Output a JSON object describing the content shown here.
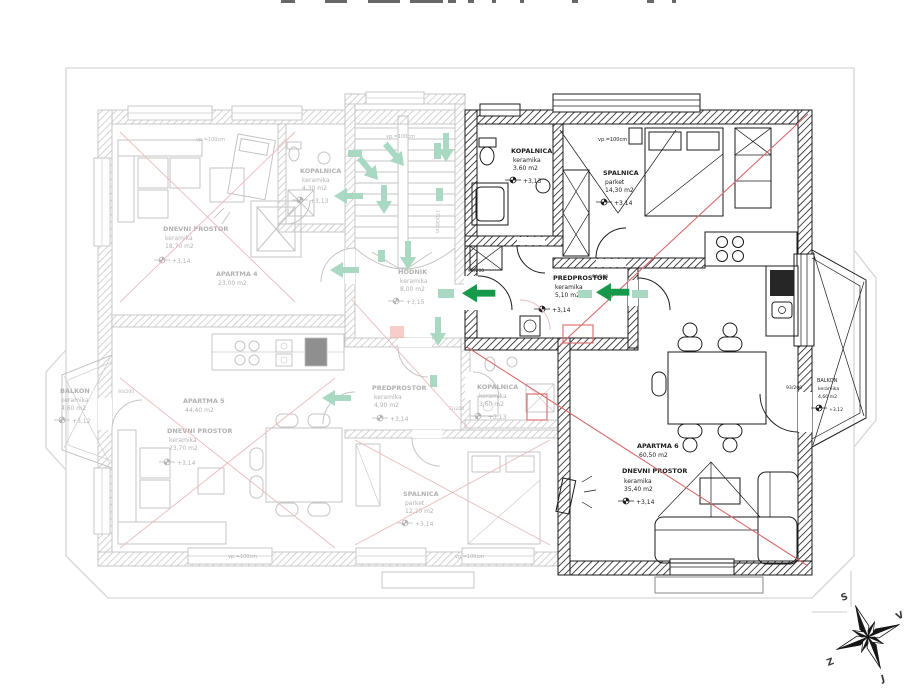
{
  "apartments": [
    {
      "label": "APARTMA 4",
      "area": "23,00 m2",
      "rooms": [
        {
          "name": "DNEVNI PROSTOR",
          "material": "keramika",
          "area": "18,70 m2",
          "level": "+3,14"
        },
        {
          "name": "KOPALNICA",
          "material": "keramika",
          "area": "4,30 m2",
          "level": "+3,13"
        }
      ]
    },
    {
      "label": "APARTMA 5",
      "area": "44,40 m2",
      "rooms": [
        {
          "name": "DNEVNI PROSTOR",
          "material": "keramika",
          "area": "23,70 m2",
          "level": "+3,14"
        },
        {
          "name": "PREDPROSTOR",
          "material": "keramika",
          "area": "4,90 m2",
          "level": "+3,14"
        },
        {
          "name": "KOPALNICA",
          "material": "keramika",
          "area": "3,60 m2",
          "level": "+3,13"
        },
        {
          "name": "SPALNICA",
          "material": "parket",
          "area": "12,20 m2",
          "level": "+3,14"
        },
        {
          "name": "BALKON",
          "material": "keramika",
          "area": "4,60 m2",
          "level": "+3,12"
        }
      ]
    },
    {
      "label": "APARTMA 6",
      "area": "60,50 m2",
      "rooms": [
        {
          "name": "KOPALNICA",
          "material": "keramika",
          "area": "3,60 m2",
          "level": "+3,13"
        },
        {
          "name": "SPALNICA",
          "material": "parket",
          "area": "14,30 m2",
          "level": "+3,14"
        },
        {
          "name": "PREDPROSTOR",
          "material": "keramika",
          "area": "5,10 m2",
          "level": "+3,14"
        },
        {
          "name": "DNEVNI PROSTOR",
          "material": "keramika",
          "area": "35,40 m2",
          "level": "+3,14"
        },
        {
          "name": "BALKON",
          "material": "keramika",
          "area": "4,60 m2",
          "level": "+3,12"
        }
      ]
    }
  ],
  "hodnik": {
    "name": "HODNIK",
    "material": "keramika",
    "area": "8,00 m2",
    "level": "+3,15"
  },
  "windows": {
    "top": "vp.=100cm",
    "shaft": "170/20cm"
  },
  "doors": {
    "balcony_left": "93/200",
    "balcony_right": "93/200",
    "entry_a6": "90/200",
    "living_a6": "90/200",
    "pred_a5": "71/200"
  },
  "compass": {
    "north": "S",
    "east": "V",
    "west": "Z",
    "south": "J"
  },
  "colors": {
    "faded": "#c5c5c5",
    "bold": "#1b1b1b",
    "mint": "#a9d8c3",
    "green": "#17994b",
    "red": "#d96a6a",
    "red_light": "#eebaba"
  }
}
